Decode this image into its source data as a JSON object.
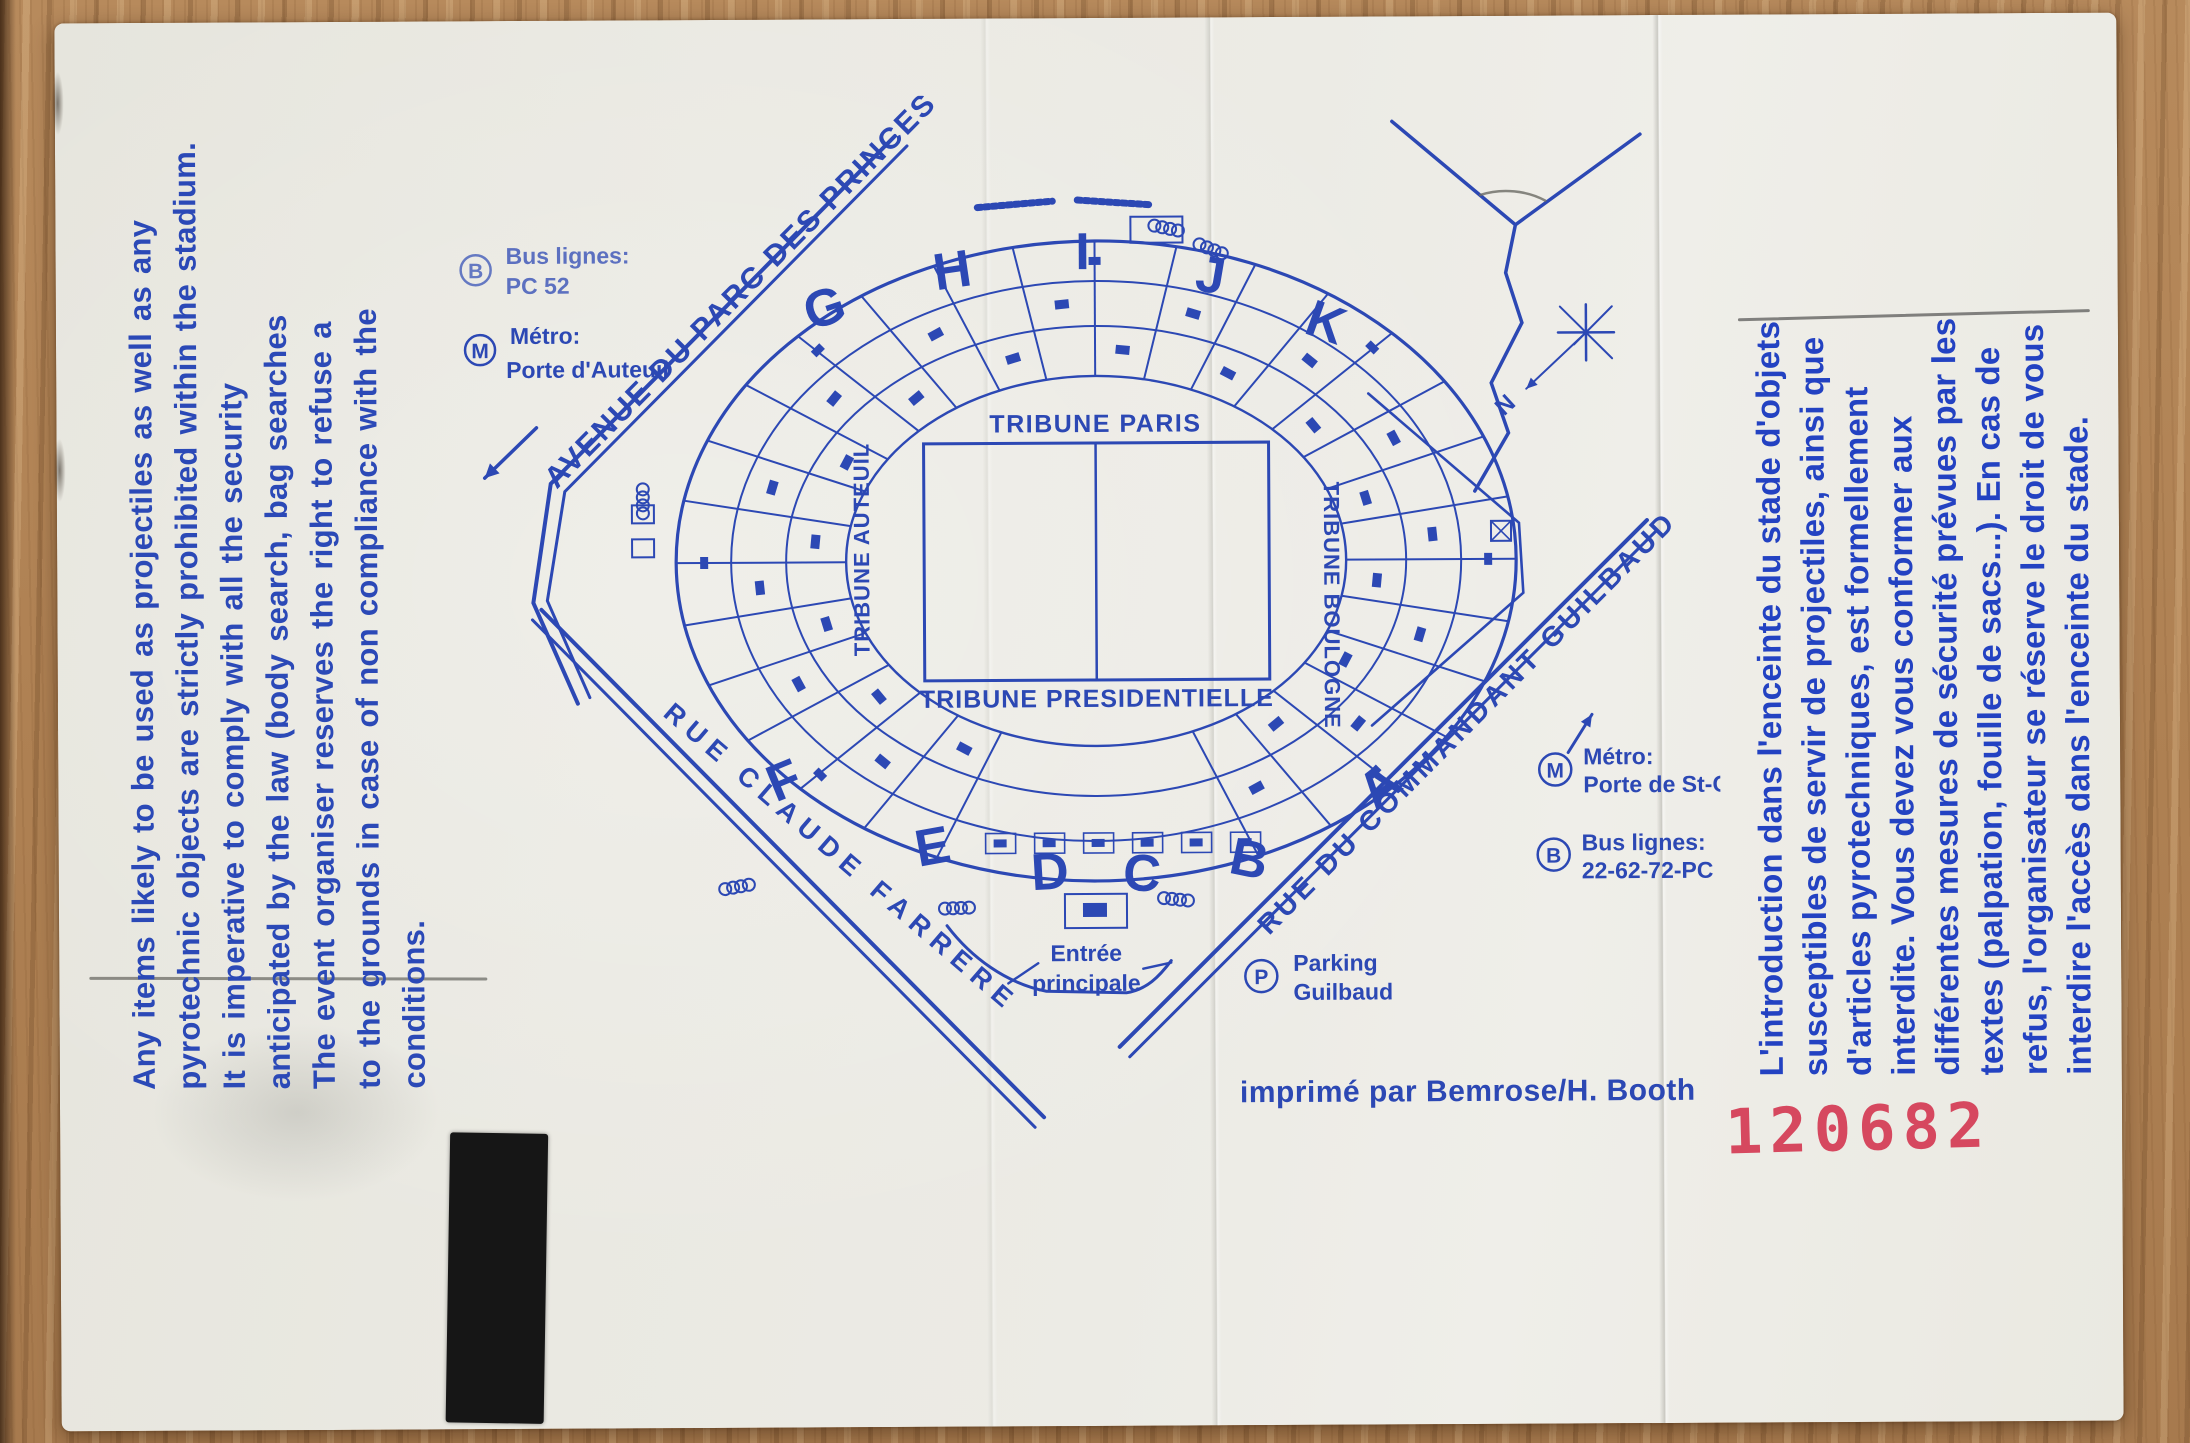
{
  "colors": {
    "ink": "#2c48b4",
    "stamp": "#d6485f",
    "paper": "#eae9e2",
    "wood": "#ae8052"
  },
  "back_text_en": {
    "lines": [
      "Any items likely to be used as projectiles as well as any",
      "pyrotechnic objects are strictly prohibited within the stadium.",
      "It is imperative to comply with all the security",
      "anticipated by the law (body search, bag searches",
      "The event organiser reserves the right to refuse a",
      "to the grounds in case of non compliance with the",
      "conditions."
    ]
  },
  "back_text_fr": {
    "lines": [
      "L'introduction dans l'enceinte du stade d'objets",
      "susceptibles de servir de projectiles, ainsi que",
      "d'articles pyrotechniques, est formellement",
      "interdite. Vous devez vous conformer aux",
      "différentes mesures de sécurité prévues par les",
      "textes (palpation, fouille de sacs...). En cas de",
      "refus, l'organisateur se réserve le droit de vous",
      "interdire l'accès dans l'enceinte du stade."
    ]
  },
  "stamp": {
    "number": "120682"
  },
  "credit": {
    "text": "imprimé par Bemrose/H. Booth"
  },
  "map": {
    "streets": {
      "avenue": "AVENUE DU PARC DES PRINCES",
      "farrere": "RUE CLAUDE FARRERE",
      "guilbaud": "RUE DU COMMANDANT GUILBAUD"
    },
    "tribunes": {
      "paris": "TRIBUNE PARIS",
      "presidentielle": "TRIBUNE PRESIDENTIELLE",
      "auteuil": "TRIBUNE AUTEUIL",
      "boulogne": "TRIBUNE BOULOGNE"
    },
    "letters": {
      "top": [
        "G",
        "H",
        "I",
        "J",
        "K"
      ],
      "bottom": [
        "F",
        "E",
        "D",
        "C",
        "B",
        "A"
      ]
    },
    "legend": {
      "bus_nw_icon": "B",
      "bus_nw_label": "Bus lignes:",
      "bus_nw_value": "PC 52",
      "metro_nw_icon": "M",
      "metro_nw_label": "Métro:",
      "metro_nw_value": "Porte d'Auteuil",
      "metro_se_icon": "M",
      "metro_se_label": "Métro:",
      "metro_se_value": "Porte de St-Cloud",
      "bus_se_icon": "B",
      "bus_se_label": "Bus lignes:",
      "bus_se_value": "22-62-72-PC",
      "parking_icon": "P",
      "parking_label": "Parking",
      "parking_value": "Guilbaud",
      "entrance_line1": "Entrée",
      "entrance_line2": "principale",
      "compass": "N"
    }
  }
}
